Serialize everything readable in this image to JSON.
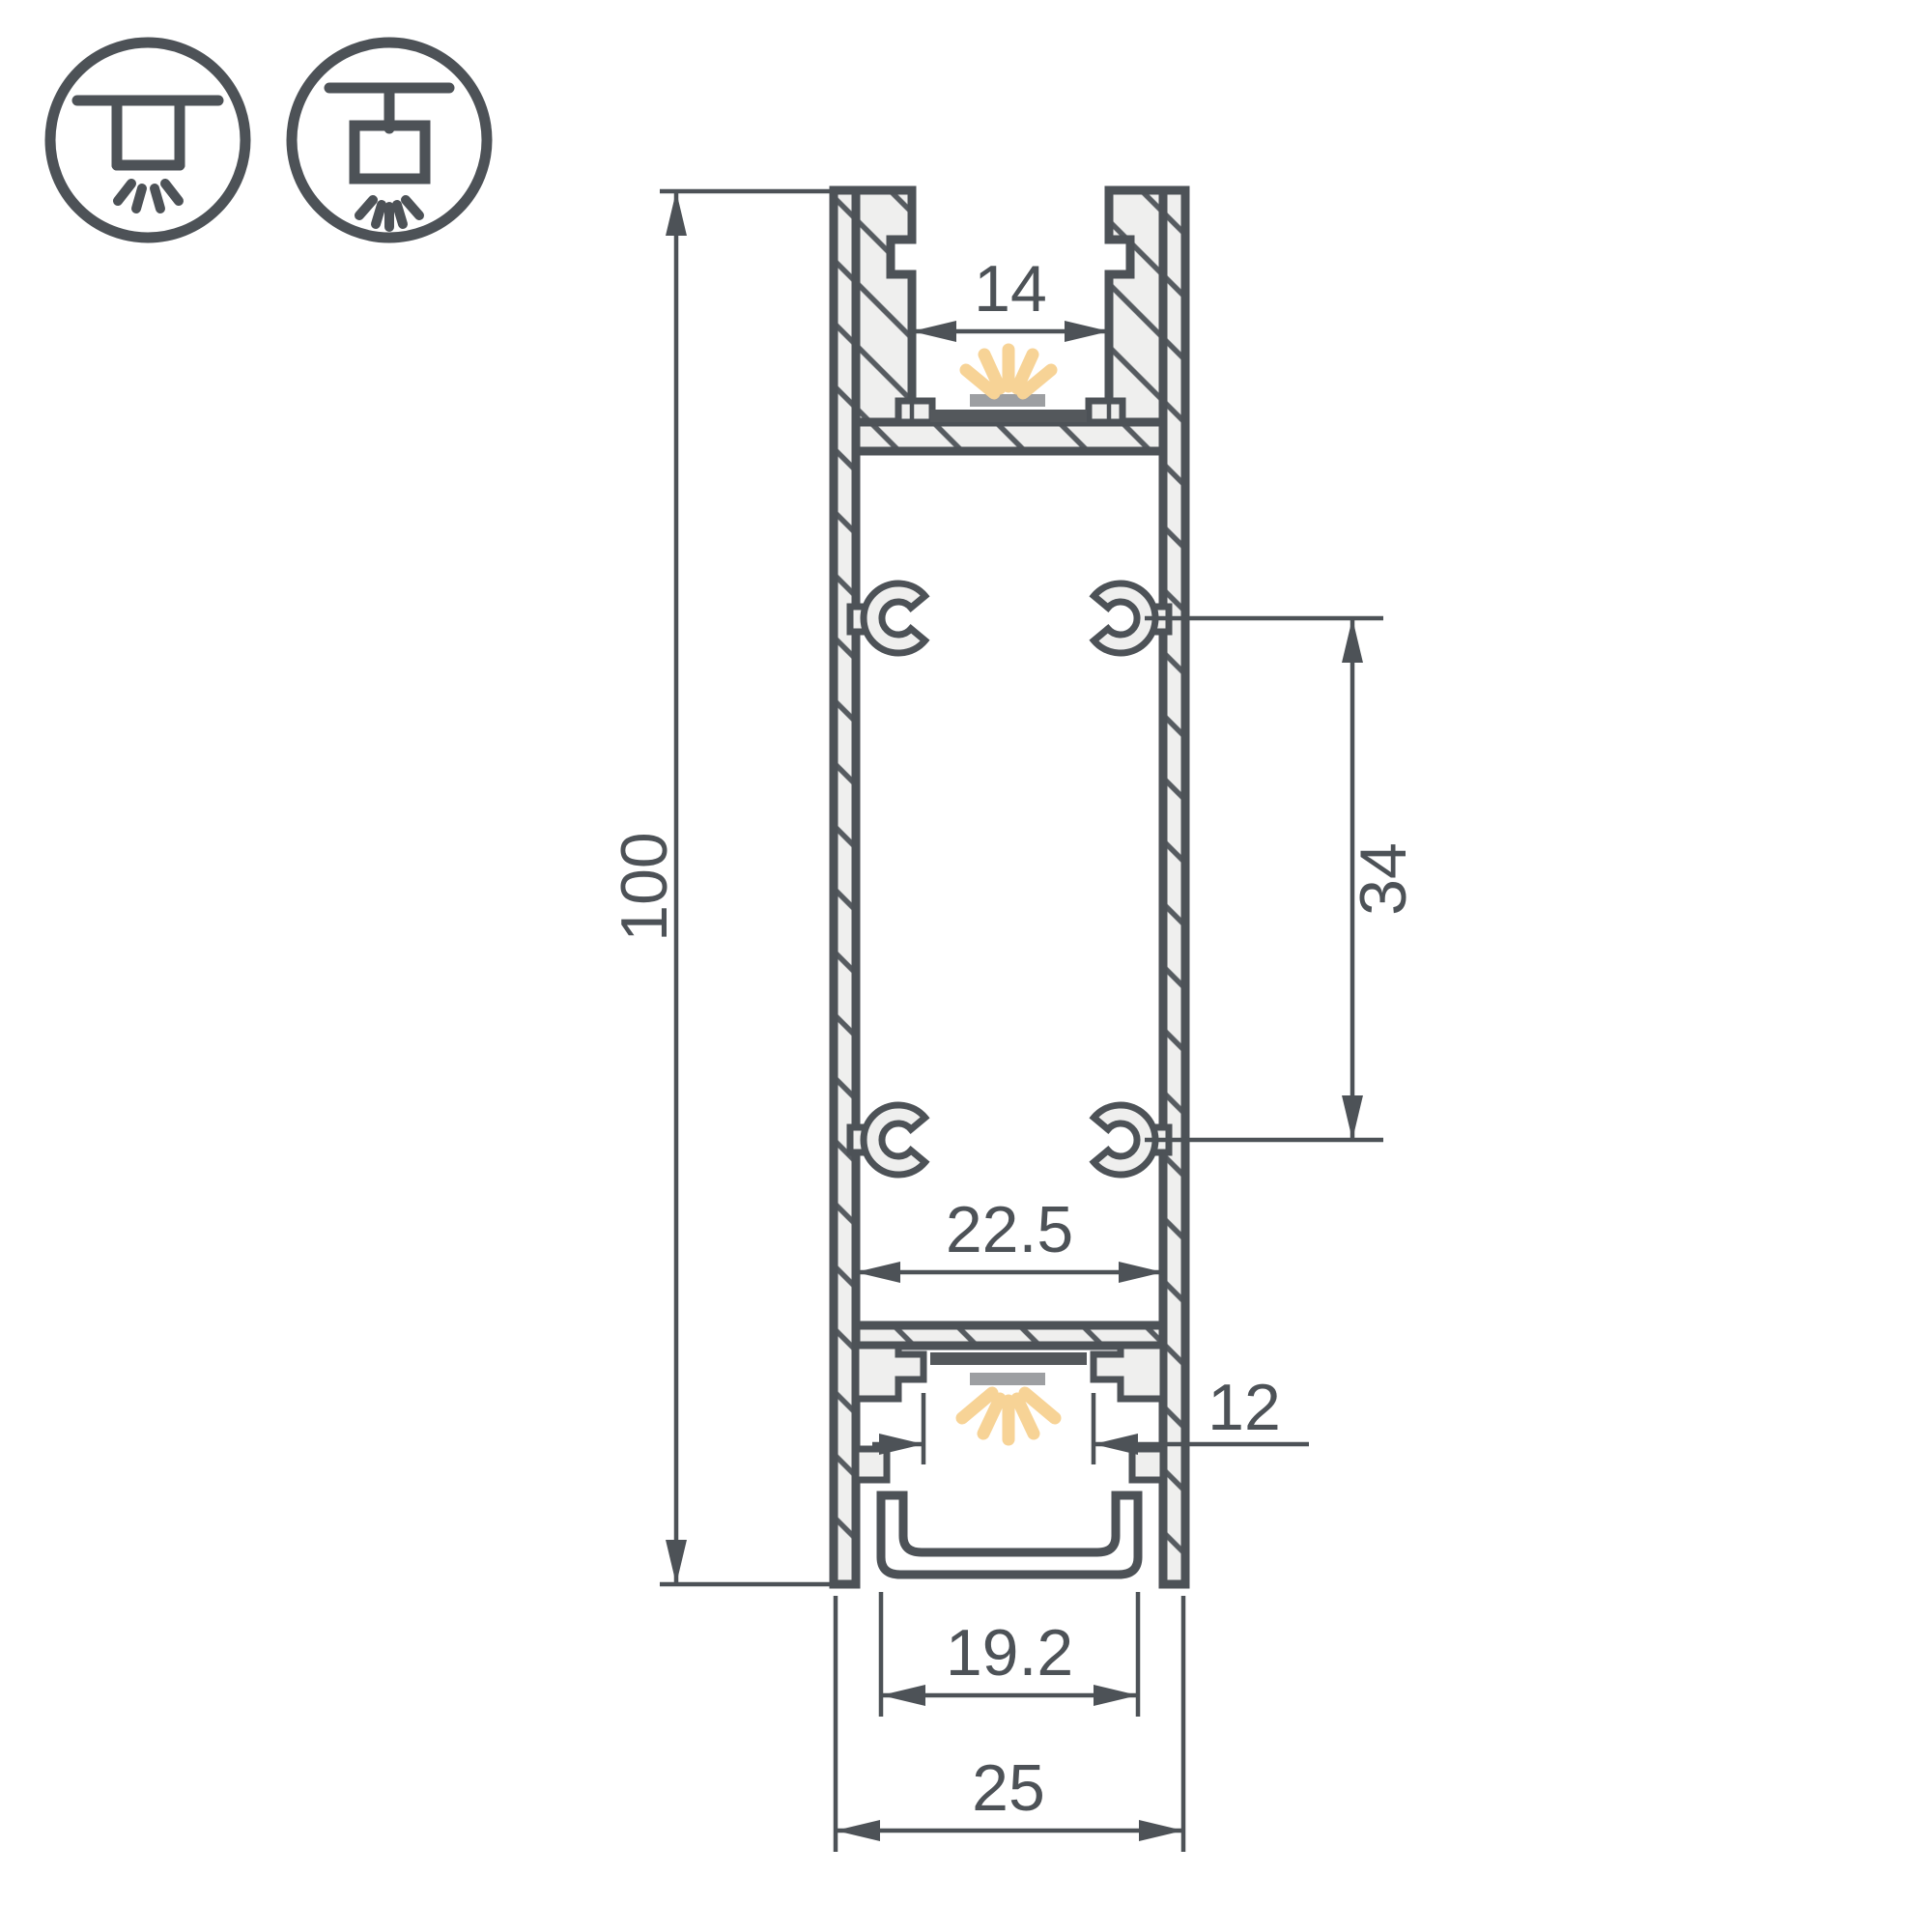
{
  "drawing": {
    "title": "led-profile-cross-section",
    "colors": {
      "line": "#4d5257",
      "metal_fill": "#efefee",
      "led_pcb": "#54585c",
      "led_body": "#9d9fa2",
      "light_ray": "#f7d396",
      "background": "#ffffff"
    },
    "mount_icons": [
      {
        "name": "surface-ceiling-mount"
      },
      {
        "name": "suspended-pendant-mount"
      }
    ],
    "dimensions": {
      "overall_height": "100",
      "top_opening_width": "14",
      "boss_spacing": "34",
      "inner_width": "22.5",
      "bottom_opening_width": "12",
      "diffuser_width": "19.2",
      "overall_width": "25"
    }
  }
}
